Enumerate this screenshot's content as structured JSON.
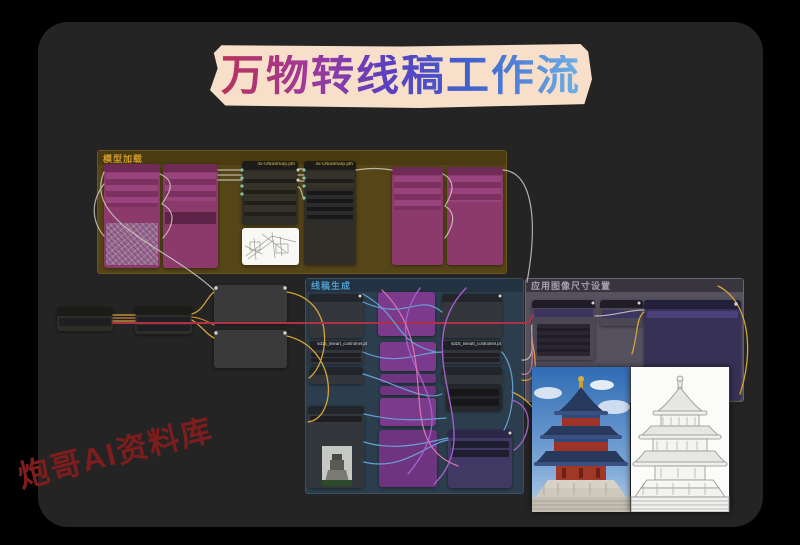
{
  "window": {
    "background": "#000000",
    "canvas_bg": "#242424"
  },
  "title_banner": {
    "text": "万物转线稿工作流",
    "bg": "#f7dfca",
    "gradient": [
      "#b8325a",
      "#5b3fc0",
      "#6fb0e6"
    ]
  },
  "watermark": {
    "text": "炮哥AI资料库",
    "color": "#7d1d1d"
  },
  "groups": {
    "loaders": {
      "label": "模型加载"
    },
    "generate": {
      "label": "线稿生成"
    },
    "apply": {
      "label": "应用图像尺寸设置"
    }
  },
  "nodes": {
    "upscale_model_1": {
      "title": "4x-UltraSharp.pth"
    },
    "upscale_model_2": {
      "title": "4x-UltraSharp.pth"
    },
    "controlnet_left": {
      "label": "sd15_lineart_controlnet.pt"
    },
    "controlnet_right": {
      "label": "sd15_lineart_controlnet.pt"
    }
  },
  "colors": {
    "loader_node": "#8c3a6c",
    "purple_node": "#7b3a8b",
    "indigo_node": "#3f3964",
    "group_olive": "#564517",
    "group_blue": "#2c3e4d",
    "group_gray": "#56515f",
    "link_red": "#ae3246",
    "link_yellow": "#d2a43a",
    "link_blue": "#68a6da",
    "link_purple": "#a35fc9"
  }
}
